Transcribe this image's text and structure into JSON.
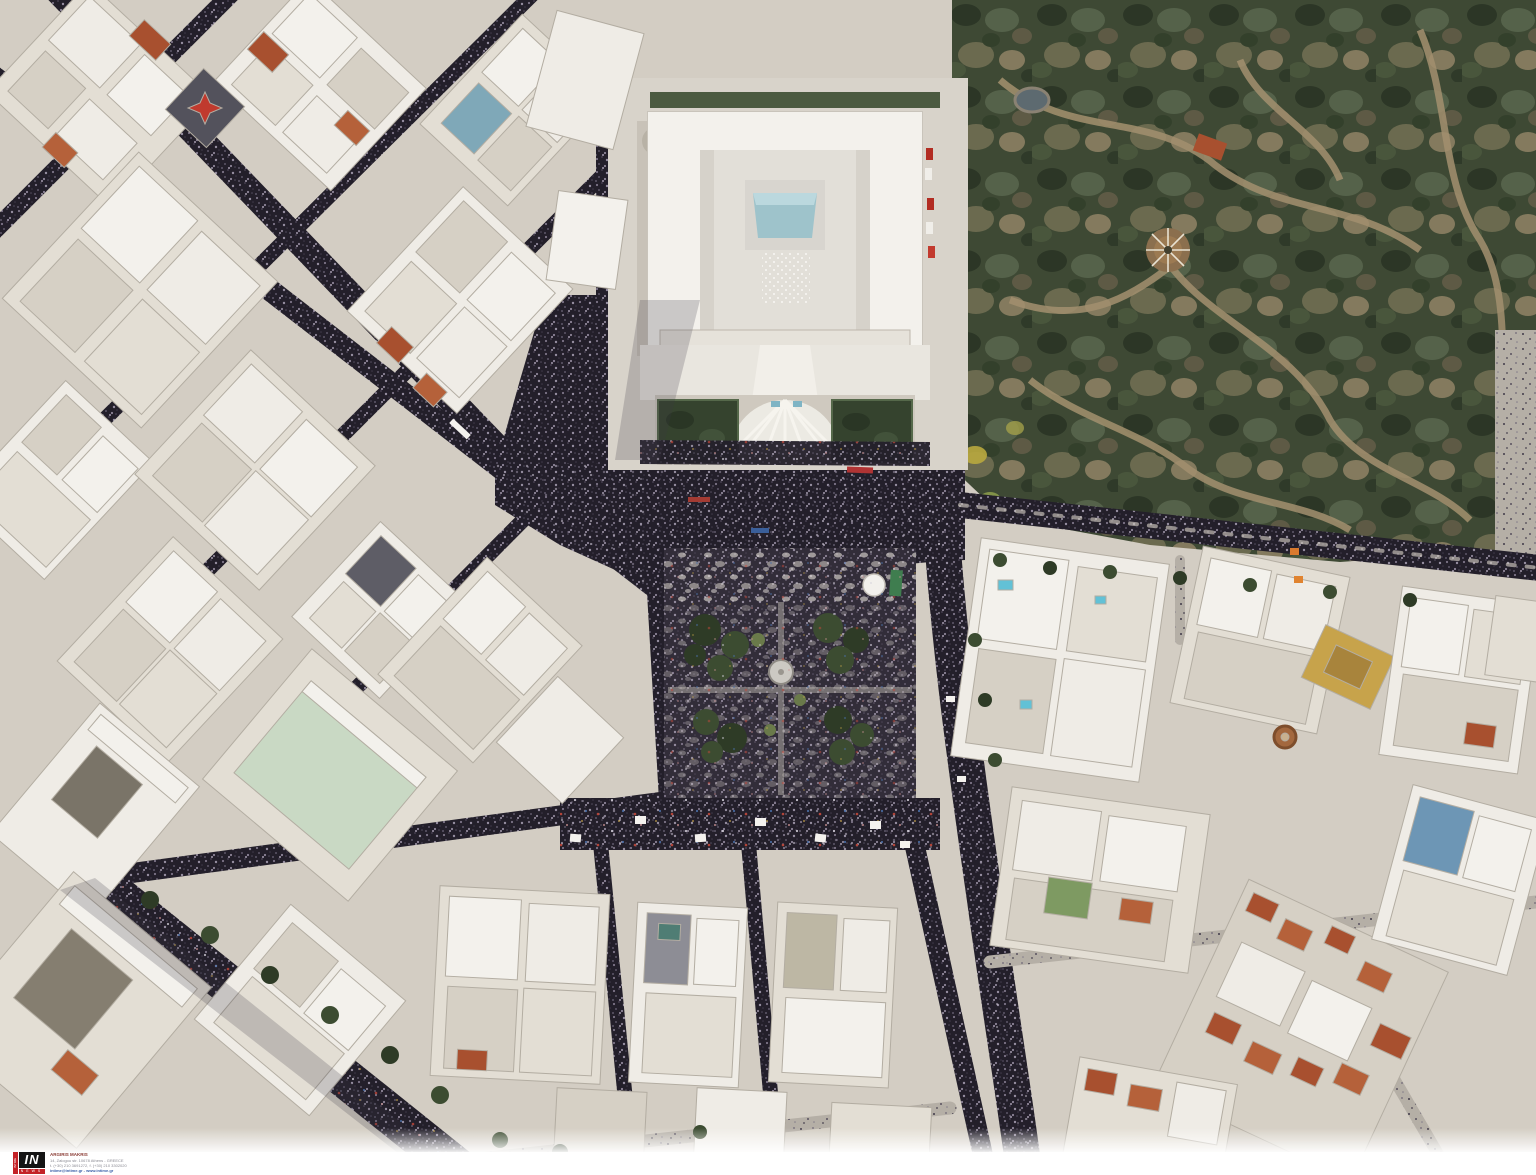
{
  "meta": {
    "description": "Aerial drone photograph of a mass demonstration filling Syntagma Square and surrounding avenues in front of the Hellenic Parliament, Athens; streets appear black with densely packed crowds, National Garden at top right, white city blocks with red tile roofs elsewhere."
  },
  "watermark": {
    "agency": "INTIME",
    "logo": {
      "main": "IN",
      "side": "INTIME",
      "bottom": "NEWS"
    },
    "photographer": "ARGIRIS MAKRIS",
    "address": "14, Zalogou str. 10678 Athens - GREECE",
    "phones": "t. (+30) 210 3691272, f. (+30) 210 3302020",
    "web": "intime@intime.gr - www.intime.gr"
  },
  "colors": {
    "accent": "#c32227",
    "link": "#3a5fa8",
    "crowd": "#231f2a",
    "pavement": "#d3cdc3",
    "parliament": "#edeae5",
    "skylight": "#9ec3cb",
    "garden": "#3e4934",
    "garden-path": "#a3906f",
    "tree": "#3c4c31",
    "roof-red": "#a8502f",
    "roof-red2": "#b5613a",
    "mint": "#c9d9c4",
    "pool": "#62c1d6",
    "yellow-building": "#c7a34b"
  }
}
